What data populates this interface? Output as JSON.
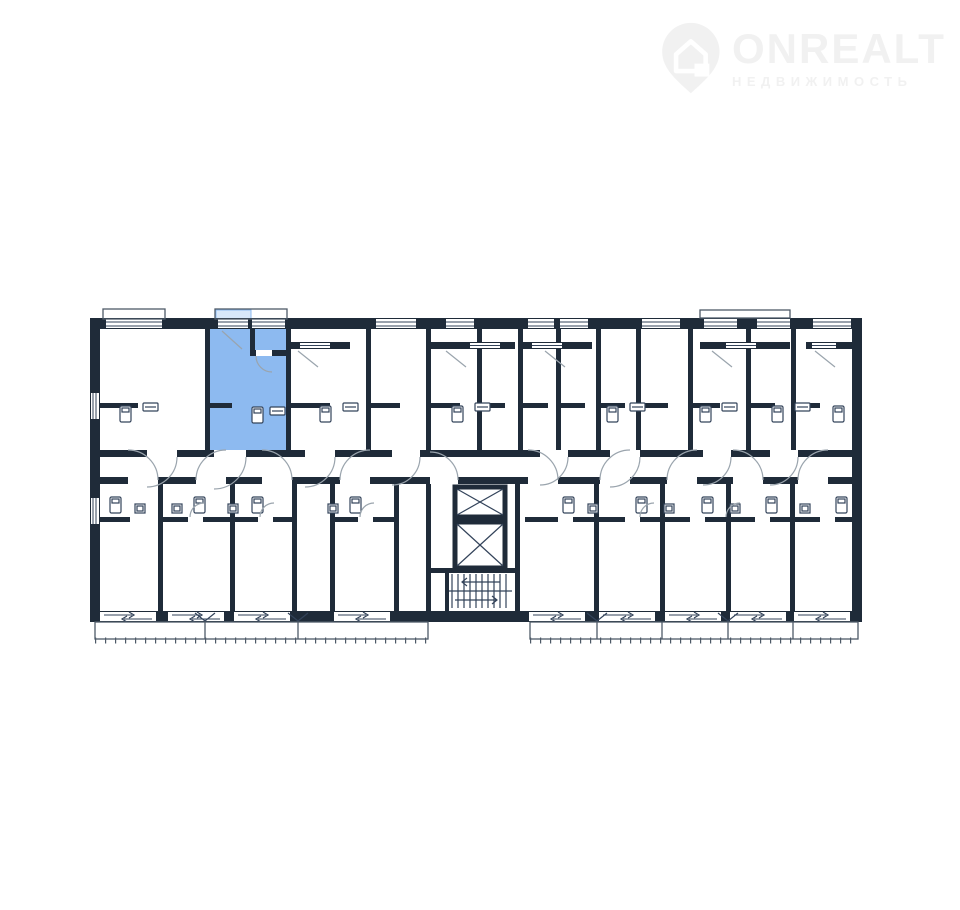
{
  "watermark": {
    "brand": "ONREALT",
    "subtitle": "НЕДВИЖИМОСТЬ",
    "icon": "house-location-pin-icon",
    "color": "#f1f1f1"
  },
  "floorplan": {
    "description": "apartment building floor plan with one highlighted studio unit",
    "highlighted_unit": {
      "name": "highlighted-studio-apartment",
      "fill": "#8dbaf0"
    },
    "colors": {
      "wall": "#1f2b39",
      "door_arc": "#9aa4ad",
      "fixture": "#33435a",
      "balcony_line": "#4e5a68",
      "highlight": "#8dbaf0",
      "highlight_light": "#d8e8fa",
      "background": "#ffffff"
    }
  }
}
